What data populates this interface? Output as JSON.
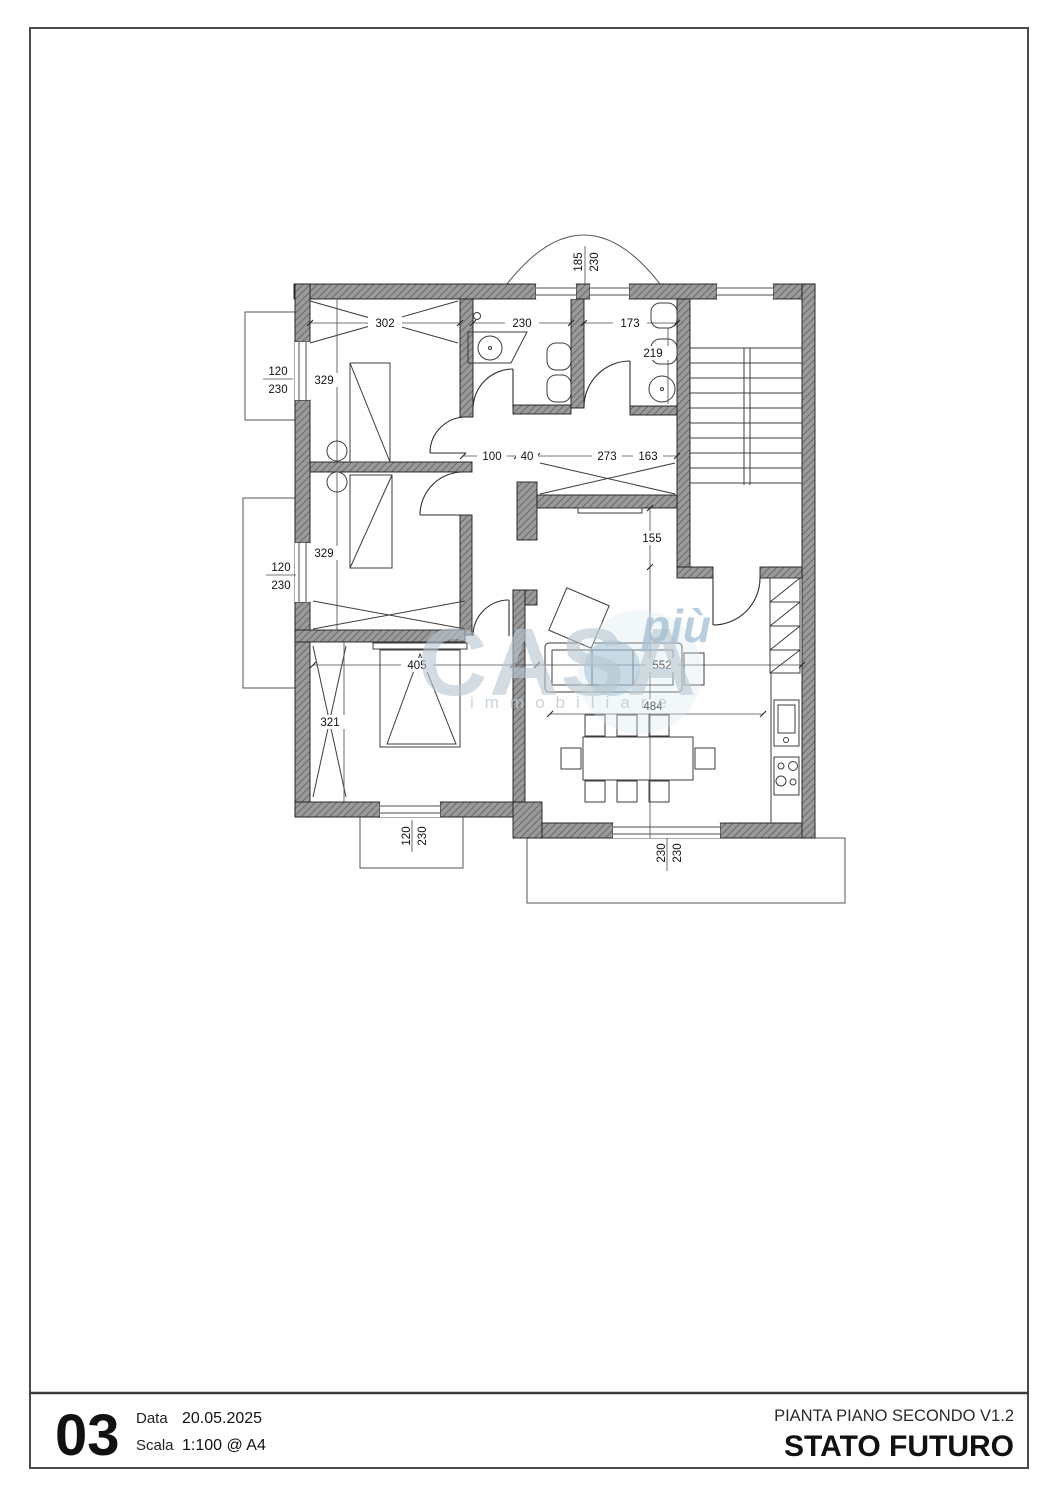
{
  "plan": {
    "dims": {
      "top1": "302",
      "top2": "230",
      "top3": "173",
      "wc_depth": "219",
      "bay_w": "185",
      "bay_h": "230",
      "win1_w": "120",
      "win1_h": "230",
      "room1_d": "329",
      "win2_w": "120",
      "win2_h": "230",
      "room2_d": "329",
      "hall_a": "100",
      "hall_b": "40",
      "hall_c": "273",
      "hall_d": "163",
      "hall_e": "155",
      "room3_w": "405",
      "room3_d": "321",
      "living_w": "552",
      "dining_w": "484",
      "win3_w": "120",
      "win3_h": "230",
      "terrace_a": "230",
      "terrace_b": "230"
    }
  },
  "watermark": {
    "brand": "CASA",
    "suffix": "più",
    "tagline": "immobiliare"
  },
  "title_block": {
    "sheet": "03",
    "data_label": "Data",
    "data_value": "20.05.2025",
    "scala_label": "Scala",
    "scala_value": "1:100 @ A4",
    "title": "PIANTA PIANO SECONDO V1.2",
    "subtitle": "STATO FUTURO"
  }
}
